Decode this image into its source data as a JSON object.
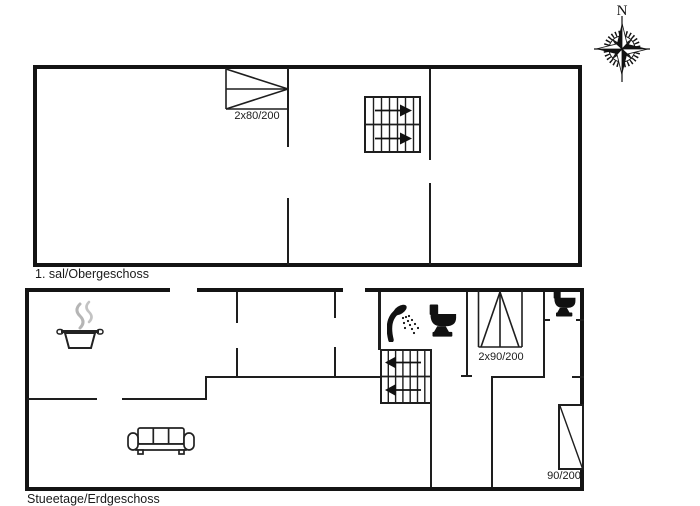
{
  "compass": {
    "north_label": "N"
  },
  "upper_floor": {
    "name": "1. sal/Obergeschoss",
    "window_label": "2x80/200"
  },
  "ground_floor": {
    "name": "Stueetage/Erdgeschoss",
    "door_label": "2x90/200",
    "bed_label": "90/200"
  },
  "icons": {
    "compass-rose-icon": "8-point compass rose, north needle",
    "stairs-up-icon": "staircase, arrows pointing right",
    "stairs-down-icon": "staircase, arrows pointing left",
    "pot-icon": "cooking pot with steam (kitchen)",
    "sofa-icon": "three-seat sofa (living room)",
    "shower-icon": "hand shower with spray (bathroom)",
    "toilet-icon": "toilet silhouette (bathroom)",
    "wc-toilet-icon": "toilet silhouette (separate WC)",
    "bed-icon": "single bed with diagonal"
  },
  "colors": {
    "walls": "#141414",
    "steam": "#b5b5b5",
    "background": "#ffffff",
    "text": "#1a1a1a"
  }
}
